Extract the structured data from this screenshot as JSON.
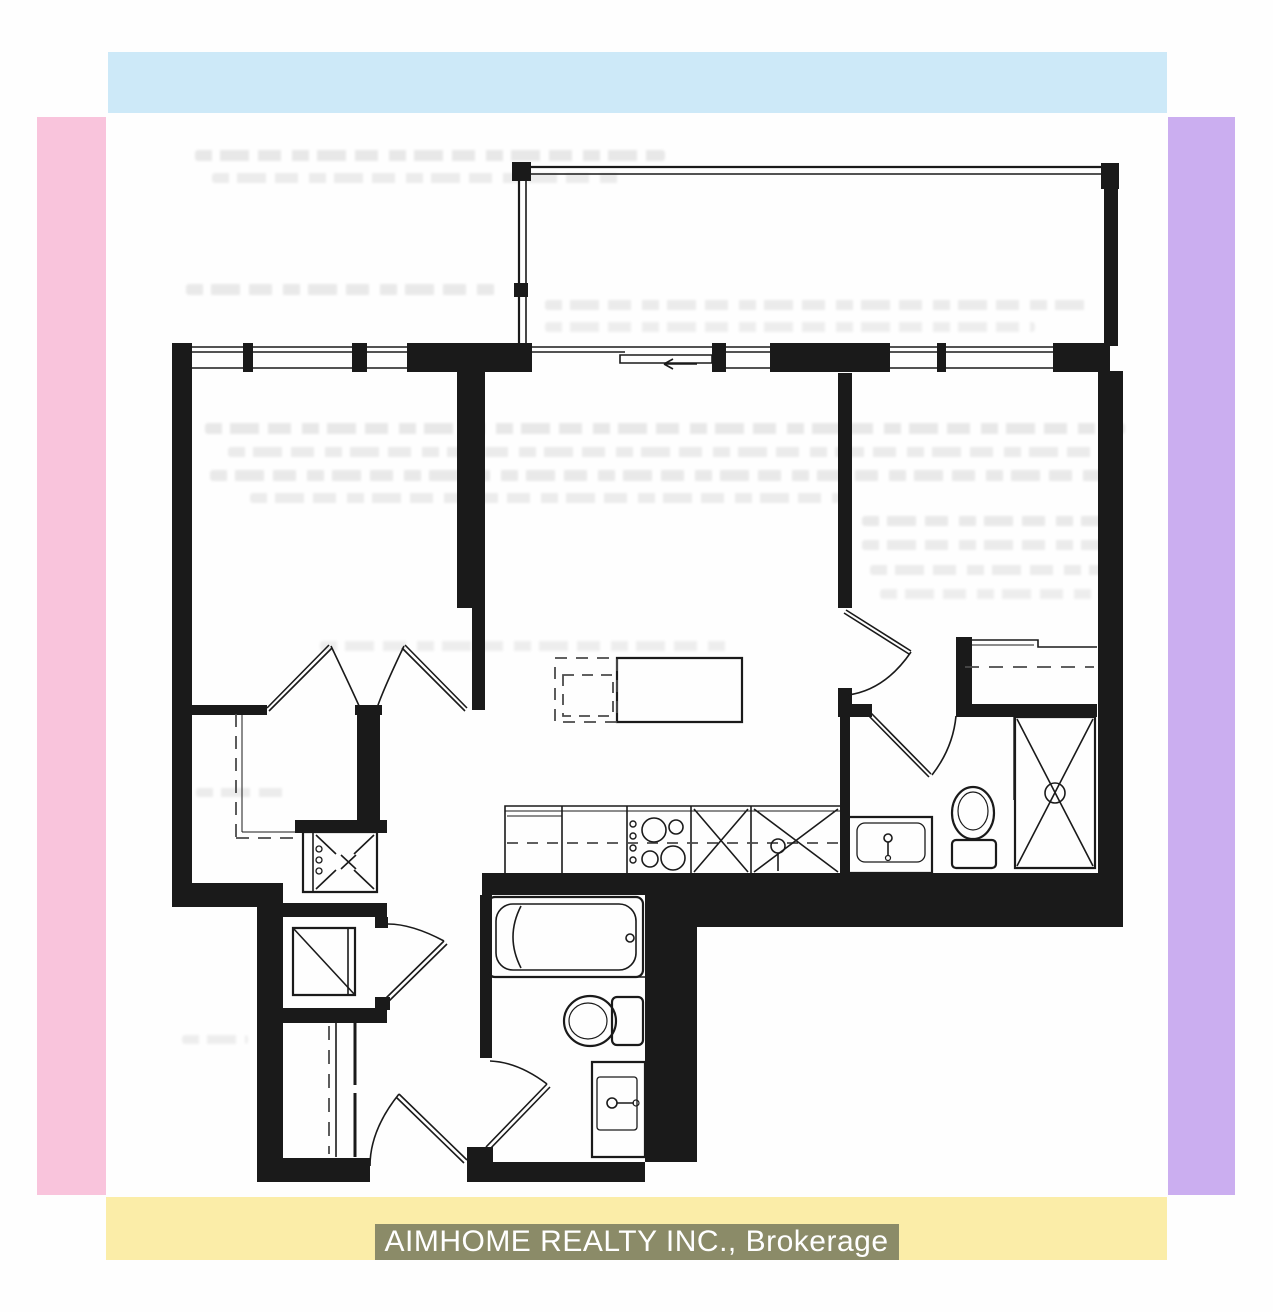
{
  "banner": {
    "brokerage_label": "AIMHOME REALTY INC., Brokerage",
    "highlight_color": "#8b8b68",
    "text_color": "#ffffff"
  },
  "frame_colors": {
    "top": "#cde9f8",
    "left": "#f9c4dc",
    "right": "#cbaef0",
    "bottom": "#fbeda8"
  },
  "floor_plan": {
    "ink_color": "#1a1a1a",
    "type": "condo-unit-floor-plan-scan",
    "text_labels_visible": false,
    "bleedthrough_text_illegible": true,
    "elements": [
      "balcony-with-railing",
      "sliding-balcony-door-with-arrow",
      "left-room-living",
      "double-closet-doors",
      "closet-dashed-shelving",
      "kitchen-island-solid",
      "kitchen-island-dashed-table",
      "kitchen-counter-with-fridge-cooktop-sink",
      "laundry-washer-box",
      "stacked-unit-square",
      "entry-closet-sliding-doors",
      "entry-door",
      "main-bathroom-tub-toilet-vanity",
      "bedroom",
      "bedroom-closet-with-rod",
      "ensuite-bathroom-vanity-toilet-shower"
    ]
  }
}
